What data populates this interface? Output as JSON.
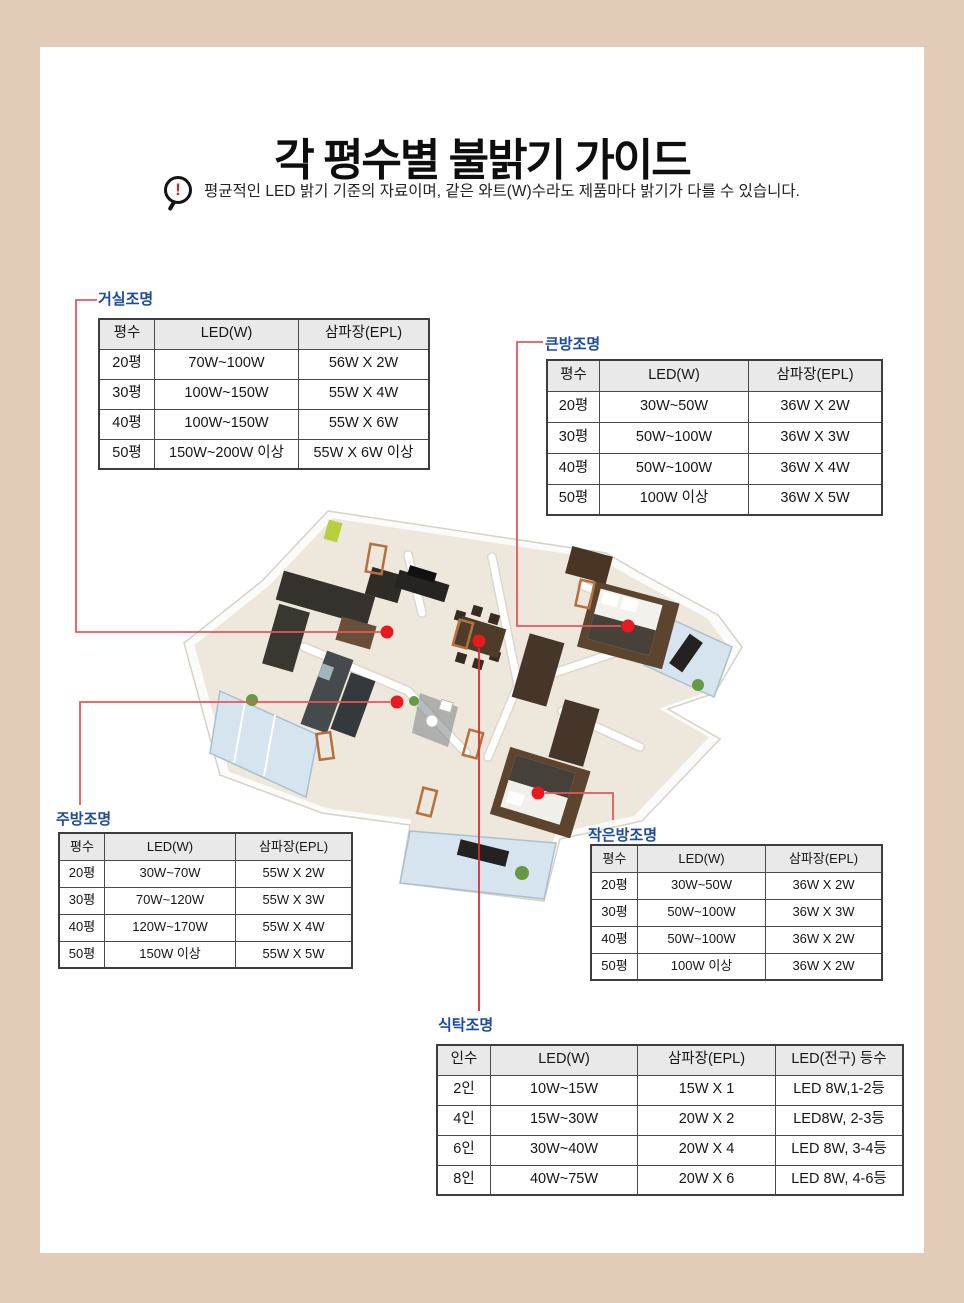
{
  "page": {
    "title": "각 평수별 불밝기 가이드",
    "notice": "평균적인 LED 밝기 기준의 자료이며, 같은 와트(W)수라도 제품마다 밝기가 다를 수 있습니다.",
    "notice_icon": "magnifier-exclamation-icon",
    "notice_exclamation": "!",
    "colors": {
      "frame_beige": "#e2ccb8",
      "label_blue": "#1d4ba0",
      "connector_red": "#e6575b",
      "marker_dot_red": "#e8191f",
      "table_header_gray": "#e9e9e9"
    }
  },
  "tables": {
    "living": {
      "label": "거실조명",
      "headers": [
        "평수",
        "LED(W)",
        "삼파장(EPL)"
      ],
      "rows": [
        [
          "20평",
          "70W~100W",
          "56W X 2W"
        ],
        [
          "30평",
          "100W~150W",
          "55W X 4W"
        ],
        [
          "40평",
          "100W~150W",
          "55W X 6W"
        ],
        [
          "50평",
          "150W~200W 이상",
          "55W X 6W 이상"
        ]
      ]
    },
    "big_room": {
      "label": "큰방조명",
      "headers": [
        "평수",
        "LED(W)",
        "삼파장(EPL)"
      ],
      "rows": [
        [
          "20평",
          "30W~50W",
          "36W X 2W"
        ],
        [
          "30평",
          "50W~100W",
          "36W X 3W"
        ],
        [
          "40평",
          "50W~100W",
          "36W X 4W"
        ],
        [
          "50평",
          "100W 이상",
          "36W X 5W"
        ]
      ]
    },
    "kitchen": {
      "label": "주방조명",
      "headers": [
        "평수",
        "LED(W)",
        "삼파장(EPL)"
      ],
      "rows": [
        [
          "20평",
          "30W~70W",
          "55W X 2W"
        ],
        [
          "30평",
          "70W~120W",
          "55W X 3W"
        ],
        [
          "40평",
          "120W~170W",
          "55W X 4W"
        ],
        [
          "50평",
          "150W 이상",
          "55W X 5W"
        ]
      ]
    },
    "small_room": {
      "label": "작은방조명",
      "headers": [
        "평수",
        "LED(W)",
        "삼파장(EPL)"
      ],
      "rows": [
        [
          "20평",
          "30W~50W",
          "36W X 2W"
        ],
        [
          "30평",
          "50W~100W",
          "36W X 3W"
        ],
        [
          "40평",
          "50W~100W",
          "36W X 2W"
        ],
        [
          "50평",
          "100W 이상",
          "36W X 2W"
        ]
      ]
    },
    "dining": {
      "label": "식탁조명",
      "headers": [
        "인수",
        "LED(W)",
        "삼파장(EPL)",
        "LED(전구) 등수"
      ],
      "rows": [
        [
          "2인",
          "10W~15W",
          "15W X 1",
          "LED 8W,1-2등"
        ],
        [
          "4인",
          "15W~30W",
          "20W X 2",
          "LED8W, 2-3등"
        ],
        [
          "6인",
          "30W~40W",
          "20W X 4",
          "LED 8W, 3-4등"
        ],
        [
          "8인",
          "40W~75W",
          "20W X 6",
          "LED 8W, 4-6등"
        ]
      ]
    }
  },
  "floorplan": {
    "markers": [
      "living-room",
      "dining-table",
      "kitchen",
      "big-room",
      "small-room"
    ]
  }
}
